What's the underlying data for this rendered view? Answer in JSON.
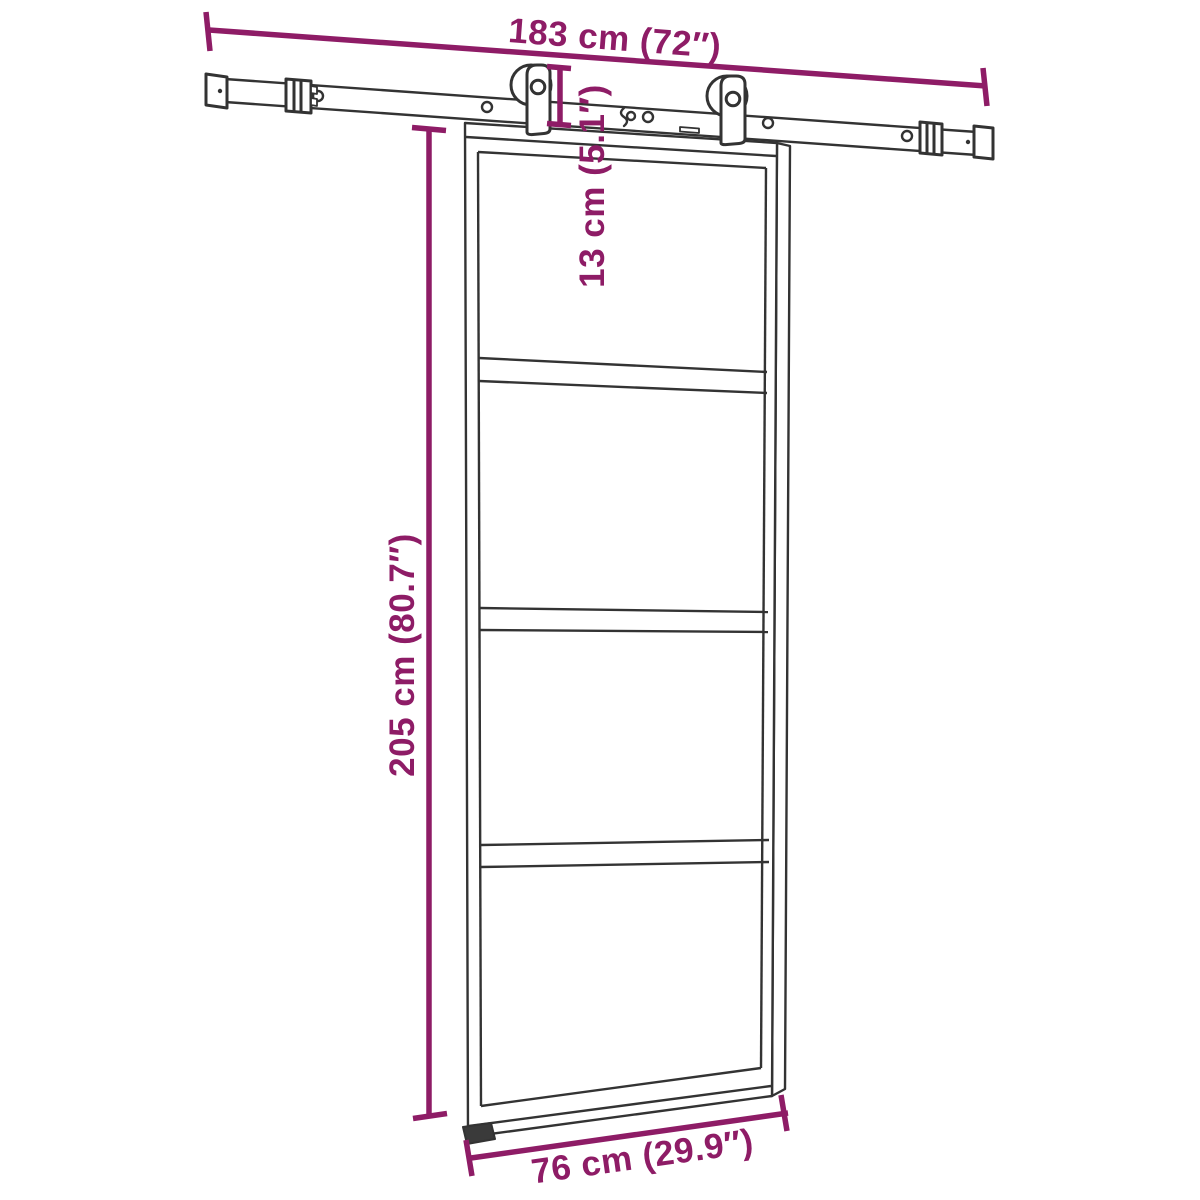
{
  "diagram": {
    "background_color": "#ffffff",
    "accent_color": "#8E1C66",
    "line_color": "#333333",
    "labels": {
      "rail_length": "183 cm (72″)",
      "hanger_drop": "13 cm (5.1″)",
      "door_height": "205 cm (80.7″)",
      "door_width": "76 cm (29.9″)"
    },
    "measurements": {
      "rail_length_cm": 183,
      "rail_length_in": 72,
      "hanger_drop_cm": 13,
      "hanger_drop_in": 5.1,
      "door_height_cm": 205,
      "door_height_in": 80.7,
      "door_width_cm": 76,
      "door_width_in": 29.9
    }
  }
}
